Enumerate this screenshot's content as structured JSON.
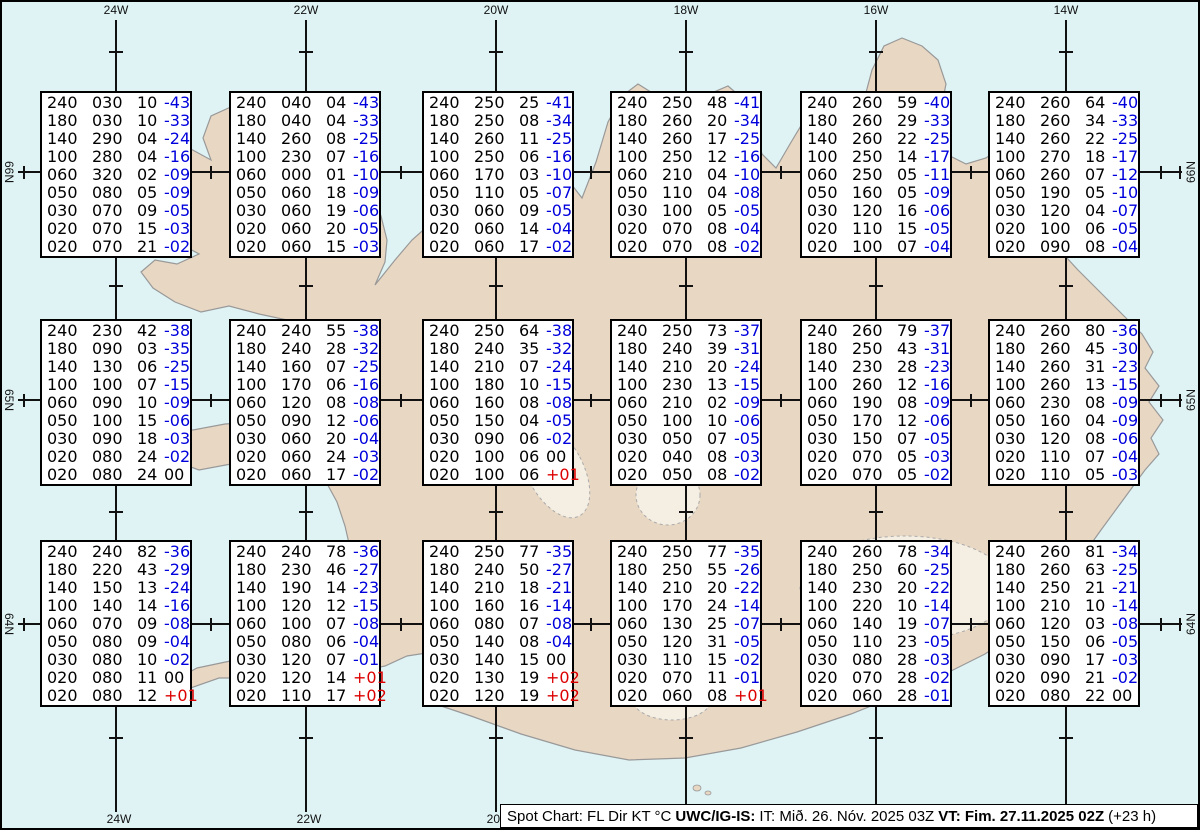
{
  "colors": {
    "sea": "#dff3f5",
    "land": "#e8d7c3",
    "coast": "#999999",
    "glacier": "#f5efe3",
    "grid": "#111111",
    "blue_temp": "#0000dd",
    "red_temp": "#dd0000"
  },
  "grid": {
    "meridians": [
      {
        "label": "24W",
        "x": 114
      },
      {
        "label": "22W",
        "x": 304
      },
      {
        "label": "20W",
        "x": 494
      },
      {
        "label": "18W",
        "x": 684
      },
      {
        "label": "16W",
        "x": 874
      },
      {
        "label": "14W",
        "x": 1064
      }
    ],
    "parallels": [
      {
        "label": "66N",
        "y": 170
      },
      {
        "label": "65N",
        "y": 398
      },
      {
        "label": "64N",
        "y": 622
      }
    ]
  },
  "spots": [
    {
      "x": 38,
      "y": 89,
      "rows": [
        [
          "240",
          "030",
          "10",
          "-43"
        ],
        [
          "180",
          "030",
          "10",
          "-33"
        ],
        [
          "140",
          "290",
          "04",
          "-24"
        ],
        [
          "100",
          "280",
          "04",
          "-16"
        ],
        [
          "060",
          "320",
          "02",
          "-09"
        ],
        [
          "050",
          "080",
          "05",
          "-09"
        ],
        [
          "030",
          "070",
          "09",
          "-05"
        ],
        [
          "020",
          "070",
          "15",
          "-03"
        ],
        [
          "020",
          "070",
          "21",
          "-02"
        ]
      ]
    },
    {
      "x": 227,
      "y": 89,
      "rows": [
        [
          "240",
          "040",
          "04",
          "-43"
        ],
        [
          "180",
          "040",
          "04",
          "-33"
        ],
        [
          "140",
          "260",
          "08",
          "-25"
        ],
        [
          "100",
          "230",
          "07",
          "-16"
        ],
        [
          "060",
          "000",
          "01",
          "-10"
        ],
        [
          "050",
          "060",
          "18",
          "-09"
        ],
        [
          "030",
          "060",
          "19",
          "-06"
        ],
        [
          "020",
          "060",
          "20",
          "-05"
        ],
        [
          "020",
          "060",
          "15",
          "-03"
        ]
      ]
    },
    {
      "x": 420,
      "y": 89,
      "rows": [
        [
          "240",
          "250",
          "25",
          "-41"
        ],
        [
          "180",
          "250",
          "08",
          "-34"
        ],
        [
          "140",
          "260",
          "11",
          "-25"
        ],
        [
          "100",
          "250",
          "06",
          "-16"
        ],
        [
          "060",
          "170",
          "03",
          "-10"
        ],
        [
          "050",
          "110",
          "05",
          "-07"
        ],
        [
          "030",
          "060",
          "09",
          "-05"
        ],
        [
          "020",
          "060",
          "14",
          "-04"
        ],
        [
          "020",
          "060",
          "17",
          "-02"
        ]
      ]
    },
    {
      "x": 608,
      "y": 89,
      "rows": [
        [
          "240",
          "250",
          "48",
          "-41"
        ],
        [
          "180",
          "260",
          "20",
          "-34"
        ],
        [
          "140",
          "260",
          "17",
          "-25"
        ],
        [
          "100",
          "250",
          "12",
          "-16"
        ],
        [
          "060",
          "210",
          "04",
          "-10"
        ],
        [
          "050",
          "110",
          "04",
          "-08"
        ],
        [
          "030",
          "100",
          "05",
          "-05"
        ],
        [
          "020",
          "070",
          "08",
          "-04"
        ],
        [
          "020",
          "070",
          "08",
          "-02"
        ]
      ]
    },
    {
      "x": 798,
      "y": 89,
      "rows": [
        [
          "240",
          "260",
          "59",
          "-40"
        ],
        [
          "180",
          "260",
          "29",
          "-33"
        ],
        [
          "140",
          "260",
          "22",
          "-25"
        ],
        [
          "100",
          "250",
          "14",
          "-17"
        ],
        [
          "060",
          "250",
          "05",
          "-11"
        ],
        [
          "050",
          "160",
          "05",
          "-09"
        ],
        [
          "030",
          "120",
          "16",
          "-06"
        ],
        [
          "020",
          "110",
          "15",
          "-05"
        ],
        [
          "020",
          "100",
          "07",
          "-04"
        ]
      ]
    },
    {
      "x": 986,
      "y": 89,
      "rows": [
        [
          "240",
          "260",
          "64",
          "-40"
        ],
        [
          "180",
          "260",
          "34",
          "-33"
        ],
        [
          "140",
          "260",
          "22",
          "-25"
        ],
        [
          "100",
          "270",
          "18",
          "-17"
        ],
        [
          "060",
          "260",
          "07",
          "-12"
        ],
        [
          "050",
          "190",
          "05",
          "-10"
        ],
        [
          "030",
          "120",
          "04",
          "-07"
        ],
        [
          "020",
          "100",
          "06",
          "-05"
        ],
        [
          "020",
          "090",
          "08",
          "-04"
        ]
      ]
    },
    {
      "x": 38,
      "y": 317,
      "rows": [
        [
          "240",
          "230",
          "42",
          "-38"
        ],
        [
          "180",
          "090",
          "03",
          "-35"
        ],
        [
          "140",
          "130",
          "06",
          "-25"
        ],
        [
          "100",
          "100",
          "07",
          "-15"
        ],
        [
          "060",
          "090",
          "10",
          "-09"
        ],
        [
          "050",
          "100",
          "15",
          "-06"
        ],
        [
          "030",
          "090",
          "18",
          "-03"
        ],
        [
          "020",
          "080",
          "24",
          "-02"
        ],
        [
          "020",
          "080",
          "24",
          "00"
        ]
      ]
    },
    {
      "x": 227,
      "y": 317,
      "rows": [
        [
          "240",
          "240",
          "55",
          "-38"
        ],
        [
          "180",
          "240",
          "28",
          "-32"
        ],
        [
          "140",
          "160",
          "07",
          "-25"
        ],
        [
          "100",
          "170",
          "06",
          "-16"
        ],
        [
          "060",
          "120",
          "08",
          "-08"
        ],
        [
          "050",
          "090",
          "12",
          "-06"
        ],
        [
          "030",
          "060",
          "20",
          "-04"
        ],
        [
          "020",
          "060",
          "24",
          "-03"
        ],
        [
          "020",
          "060",
          "17",
          "-02"
        ]
      ]
    },
    {
      "x": 420,
      "y": 317,
      "rows": [
        [
          "240",
          "250",
          "64",
          "-38"
        ],
        [
          "180",
          "240",
          "35",
          "-32"
        ],
        [
          "140",
          "210",
          "07",
          "-24"
        ],
        [
          "100",
          "180",
          "10",
          "-15"
        ],
        [
          "060",
          "160",
          "08",
          "-08"
        ],
        [
          "050",
          "150",
          "04",
          "-05"
        ],
        [
          "030",
          "090",
          "06",
          "-02"
        ],
        [
          "020",
          "100",
          "06",
          "00"
        ],
        [
          "020",
          "100",
          "06",
          "+01"
        ]
      ]
    },
    {
      "x": 608,
      "y": 317,
      "rows": [
        [
          "240",
          "250",
          "73",
          "-37"
        ],
        [
          "180",
          "240",
          "39",
          "-31"
        ],
        [
          "140",
          "210",
          "20",
          "-24"
        ],
        [
          "100",
          "230",
          "13",
          "-15"
        ],
        [
          "060",
          "210",
          "02",
          "-09"
        ],
        [
          "050",
          "100",
          "10",
          "-06"
        ],
        [
          "030",
          "050",
          "07",
          "-05"
        ],
        [
          "020",
          "040",
          "08",
          "-03"
        ],
        [
          "020",
          "050",
          "08",
          "-02"
        ]
      ]
    },
    {
      "x": 798,
      "y": 317,
      "rows": [
        [
          "240",
          "260",
          "79",
          "-37"
        ],
        [
          "180",
          "250",
          "43",
          "-31"
        ],
        [
          "140",
          "230",
          "28",
          "-23"
        ],
        [
          "100",
          "260",
          "12",
          "-16"
        ],
        [
          "060",
          "190",
          "08",
          "-09"
        ],
        [
          "050",
          "170",
          "12",
          "-06"
        ],
        [
          "030",
          "150",
          "07",
          "-05"
        ],
        [
          "020",
          "070",
          "05",
          "-03"
        ],
        [
          "020",
          "070",
          "05",
          "-02"
        ]
      ]
    },
    {
      "x": 986,
      "y": 317,
      "rows": [
        [
          "240",
          "260",
          "80",
          "-36"
        ],
        [
          "180",
          "260",
          "45",
          "-30"
        ],
        [
          "140",
          "260",
          "31",
          "-23"
        ],
        [
          "100",
          "260",
          "13",
          "-15"
        ],
        [
          "060",
          "230",
          "08",
          "-09"
        ],
        [
          "050",
          "160",
          "04",
          "-09"
        ],
        [
          "030",
          "120",
          "08",
          "-06"
        ],
        [
          "020",
          "110",
          "07",
          "-04"
        ],
        [
          "020",
          "110",
          "05",
          "-03"
        ]
      ]
    },
    {
      "x": 38,
      "y": 538,
      "rows": [
        [
          "240",
          "240",
          "82",
          "-36"
        ],
        [
          "180",
          "220",
          "43",
          "-29"
        ],
        [
          "140",
          "150",
          "13",
          "-24"
        ],
        [
          "100",
          "140",
          "14",
          "-16"
        ],
        [
          "060",
          "070",
          "09",
          "-08"
        ],
        [
          "050",
          "080",
          "09",
          "-04"
        ],
        [
          "030",
          "080",
          "10",
          "-02"
        ],
        [
          "020",
          "080",
          "11",
          "00"
        ],
        [
          "020",
          "080",
          "12",
          "+01"
        ]
      ]
    },
    {
      "x": 227,
      "y": 538,
      "rows": [
        [
          "240",
          "240",
          "78",
          "-36"
        ],
        [
          "180",
          "230",
          "46",
          "-27"
        ],
        [
          "140",
          "190",
          "14",
          "-23"
        ],
        [
          "100",
          "120",
          "12",
          "-15"
        ],
        [
          "060",
          "100",
          "07",
          "-08"
        ],
        [
          "050",
          "080",
          "06",
          "-04"
        ],
        [
          "030",
          "120",
          "07",
          "-01"
        ],
        [
          "020",
          "120",
          "14",
          "+01"
        ],
        [
          "020",
          "110",
          "17",
          "+02"
        ]
      ]
    },
    {
      "x": 420,
      "y": 538,
      "rows": [
        [
          "240",
          "250",
          "77",
          "-35"
        ],
        [
          "180",
          "240",
          "50",
          "-27"
        ],
        [
          "140",
          "210",
          "18",
          "-21"
        ],
        [
          "100",
          "160",
          "16",
          "-14"
        ],
        [
          "060",
          "080",
          "07",
          "-08"
        ],
        [
          "050",
          "140",
          "08",
          "-04"
        ],
        [
          "030",
          "140",
          "15",
          "00"
        ],
        [
          "020",
          "130",
          "19",
          "+02"
        ],
        [
          "020",
          "120",
          "19",
          "+02"
        ]
      ]
    },
    {
      "x": 608,
      "y": 538,
      "rows": [
        [
          "240",
          "250",
          "77",
          "-35"
        ],
        [
          "180",
          "250",
          "55",
          "-26"
        ],
        [
          "140",
          "210",
          "20",
          "-22"
        ],
        [
          "100",
          "170",
          "24",
          "-14"
        ],
        [
          "060",
          "130",
          "25",
          "-07"
        ],
        [
          "050",
          "120",
          "31",
          "-05"
        ],
        [
          "030",
          "110",
          "15",
          "-02"
        ],
        [
          "020",
          "070",
          "11",
          "-01"
        ],
        [
          "020",
          "060",
          "08",
          "+01"
        ]
      ]
    },
    {
      "x": 798,
      "y": 538,
      "rows": [
        [
          "240",
          "260",
          "78",
          "-34"
        ],
        [
          "180",
          "250",
          "60",
          "-25"
        ],
        [
          "140",
          "230",
          "20",
          "-22"
        ],
        [
          "100",
          "220",
          "10",
          "-14"
        ],
        [
          "060",
          "140",
          "19",
          "-07"
        ],
        [
          "050",
          "110",
          "23",
          "-05"
        ],
        [
          "030",
          "080",
          "28",
          "-03"
        ],
        [
          "020",
          "070",
          "28",
          "-02"
        ],
        [
          "020",
          "060",
          "28",
          "-01"
        ]
      ]
    },
    {
      "x": 986,
      "y": 538,
      "rows": [
        [
          "240",
          "260",
          "81",
          "-34"
        ],
        [
          "180",
          "260",
          "63",
          "-25"
        ],
        [
          "140",
          "250",
          "21",
          "-21"
        ],
        [
          "100",
          "210",
          "10",
          "-14"
        ],
        [
          "060",
          "120",
          "03",
          "-08"
        ],
        [
          "050",
          "150",
          "06",
          "-05"
        ],
        [
          "030",
          "090",
          "17",
          "-03"
        ],
        [
          "020",
          "090",
          "21",
          "-02"
        ],
        [
          "020",
          "080",
          "22",
          "00"
        ]
      ]
    }
  ],
  "footer": {
    "prefix": "Spot Chart: FL Dir KT °C",
    "source": "UWC/IG-IS:",
    "issue": "IT: Mið. 26. Nóv. 2025 03Z",
    "valid": "VT: Fim. 27.11.2025 02Z",
    "suffix": "(+23 h)"
  }
}
